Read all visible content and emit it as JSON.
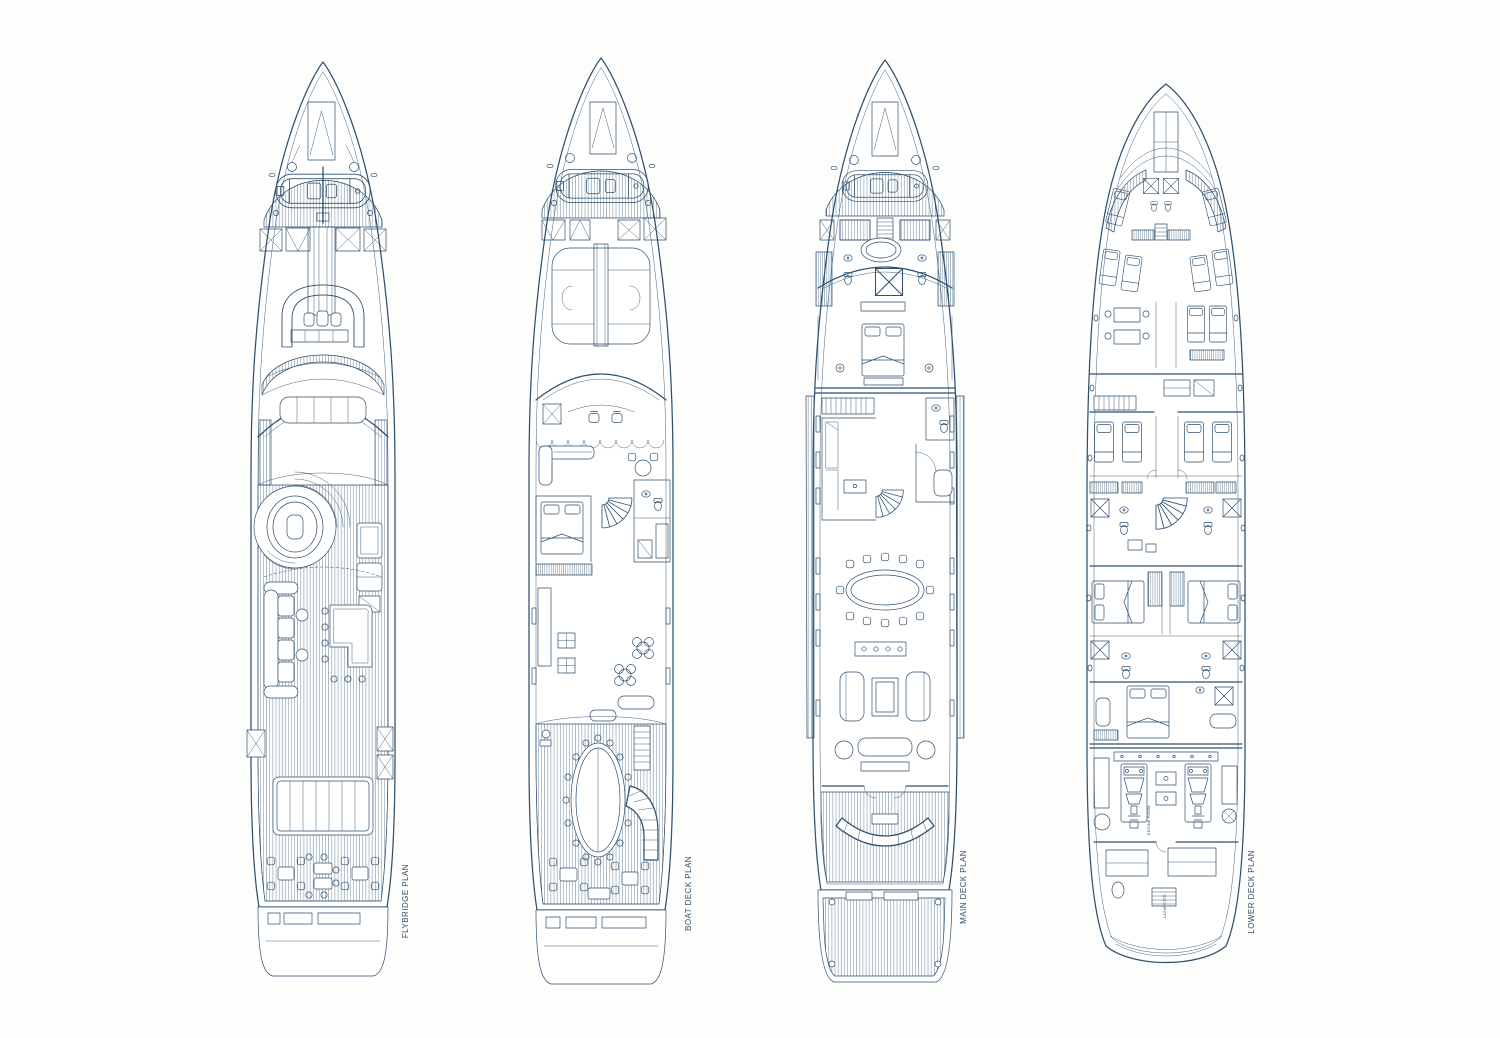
{
  "page": {
    "background": "#fdfdfb",
    "ink": "#2e506e",
    "paper": "#ffffff"
  },
  "decks": [
    {
      "id": "flybridge",
      "label": "FLYBRIDGE PLAN"
    },
    {
      "id": "boat-deck",
      "label": "BOAT DECK PLAN"
    },
    {
      "id": "main-deck",
      "label": "MAIN DECK PLAN"
    },
    {
      "id": "lower-deck",
      "label": "LOWER DECK PLAN",
      "annotations": {
        "engine_room": "ENGINE ROOM",
        "lazarette": "LAZARETTE"
      }
    }
  ]
}
